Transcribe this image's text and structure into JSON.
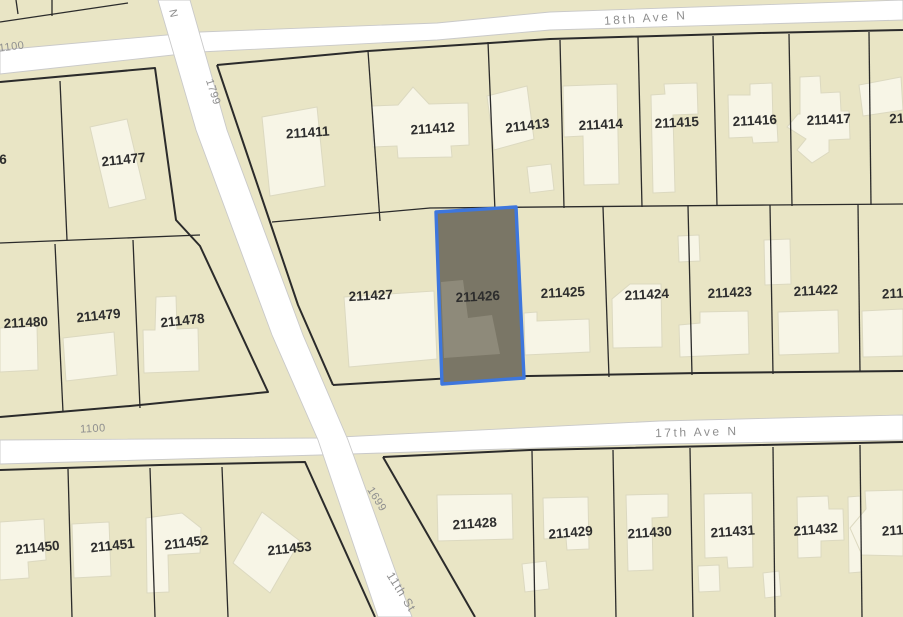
{
  "map": {
    "colors": {
      "parcel_fill": "#e9e5c5",
      "street_fill": "#ffffff",
      "street_casing": "#c9c9c9",
      "parcel_line": "#2b2b2b",
      "building_fill": "#f7f5e6",
      "building_stroke": "#dcd9c0",
      "selected_fill": "#7a7666",
      "selected_stroke": "#3d76dd",
      "selected_building_fill": "#8e8a7a",
      "parcel_label_color": "#2d2d2d",
      "street_label_color": "#8f8f8f"
    },
    "streets": [
      {
        "name": "18th-ave-n",
        "points": "0,50 200,32 437,23 550,12 903,0 903,20 550,30 437,40 200,52 0,74"
      },
      {
        "name": "17th-ave-n",
        "points": "0,440 320,438 660,421 903,415 903,440 660,444 320,455 0,464"
      },
      {
        "name": "cross-street-11th-st",
        "points": "158,0 196,130 233,230 272,335 318,440 378,617 412,617 348,440 303,335 264,230 227,130 190,0"
      }
    ],
    "street_labels": [
      {
        "text": "18th Ave N",
        "x": 646,
        "y": 22,
        "rotate": -4,
        "size": 12,
        "spacing": 2.5
      },
      {
        "text": "17th Ave N",
        "x": 697,
        "y": 436,
        "rotate": -1.5,
        "size": 12,
        "spacing": 2.5
      },
      {
        "text": "1100",
        "x": 12,
        "y": 50,
        "rotate": -7,
        "size": 11,
        "spacing": 0.5
      },
      {
        "text": "1100",
        "x": 93,
        "y": 432,
        "rotate": -3,
        "size": 11,
        "spacing": 0.5
      },
      {
        "text": "1799",
        "x": 210,
        "y": 93,
        "rotate": 72,
        "size": 11,
        "spacing": 0.5
      },
      {
        "text": "1699",
        "x": 374,
        "y": 501,
        "rotate": 58,
        "size": 11,
        "spacing": 0.5
      },
      {
        "text": "11th St",
        "x": 398,
        "y": 594,
        "rotate": 58,
        "size": 12,
        "spacing": 1
      },
      {
        "text": "N",
        "x": 170,
        "y": 14,
        "rotate": 78,
        "size": 11,
        "spacing": 0
      }
    ],
    "parcel_lines": [
      {
        "w": 2,
        "points": "0,82 155,68 176,220 200,246 268,392 130,406 0,417"
      },
      {
        "w": 2,
        "points": "217,65 368,51 550,39 760,33 903,30"
      },
      {
        "w": 2,
        "points": "217,65 245,148 270,222 298,305 333,385"
      },
      {
        "w": 2,
        "points": "333,385 470,377 700,373 903,371"
      },
      {
        "w": 2,
        "points": "0,470 160,465 305,462 375,617"
      },
      {
        "w": 2,
        "points": "383,457 530,450 760,445 903,442"
      },
      {
        "w": 2,
        "points": "383,457 475,617"
      },
      {
        "w": 1.3,
        "points": "0,22 128,3"
      },
      {
        "w": 1.3,
        "points": "52,0 52,16"
      },
      {
        "w": 1.3,
        "points": "16,0 18,14"
      },
      {
        "w": 1.3,
        "points": "0,243 200,235"
      },
      {
        "w": 1.3,
        "points": "60,81 67,240"
      },
      {
        "w": 1.3,
        "points": "55,244 63,412"
      },
      {
        "w": 1.3,
        "points": "133,240 140,408"
      },
      {
        "w": 1.3,
        "points": "272,222 430,208 770,205 903,204"
      },
      {
        "w": 1.3,
        "points": "368,51 380,221"
      },
      {
        "w": 1.3,
        "points": "488,42 495,211"
      },
      {
        "w": 1.3,
        "points": "560,40 564,208"
      },
      {
        "w": 1.3,
        "points": "638,37 642,207"
      },
      {
        "w": 1.3,
        "points": "713,36 717,206"
      },
      {
        "w": 1.3,
        "points": "789,34 792,206"
      },
      {
        "w": 1.3,
        "points": "869,32 871,205"
      },
      {
        "w": 1.3,
        "points": "603,207 609,377"
      },
      {
        "w": 1.3,
        "points": "688,206 692,375"
      },
      {
        "w": 1.3,
        "points": "770,205 773,374"
      },
      {
        "w": 1.3,
        "points": "858,204 860,372"
      },
      {
        "w": 1.3,
        "points": "68,469 72,617"
      },
      {
        "w": 1.3,
        "points": "150,468 155,617"
      },
      {
        "w": 1.3,
        "points": "222,467 228,617"
      },
      {
        "w": 1.3,
        "points": "532,451 535,617"
      },
      {
        "w": 1.3,
        "points": "613,450 616,617"
      },
      {
        "w": 1.3,
        "points": "690,448 693,617"
      },
      {
        "w": 1.3,
        "points": "773,447 775,617"
      },
      {
        "w": 1.3,
        "points": "860,445 862,617"
      }
    ],
    "buildings": [
      {
        "points": "90,127 127,119 146,199 109,208"
      },
      {
        "points": "0,328 37,326 38,370 0,372"
      },
      {
        "points": "63,338 114,332 117,375 66,381"
      },
      {
        "points": "156,297 176,296 177,329 198,328 199,371 144,373 143,330 155,330"
      },
      {
        "points": "262,117 317,107 325,186 270,196"
      },
      {
        "points": "372,106 398,105 413,87 429,104 468,103 469,145 451,146 452,157 398,158 397,146 373,147"
      },
      {
        "points": "487,96 527,86 534,139 494,150"
      },
      {
        "points": "527,167 551,164 554,190 530,193"
      },
      {
        "points": "563,86 617,84 619,184 584,185 583,136 564,137"
      },
      {
        "points": "651,95 665,94 664,84 697,83 698,114 673,115 675,192 653,193"
      },
      {
        "points": "750,84 772,83 773,124 777,124 778,142 753,143 752,137 729,138 728,95 750,95"
      },
      {
        "points": "800,77 820,76 821,93 840,92 841,111 849,111 850,139 829,140 829,152 812,163 797,150 806,139 787,127 798,114 800,114"
      },
      {
        "points": "859,85 901,77 903,110 863,116"
      },
      {
        "points": "344,297 434,291 437,359 349,367"
      },
      {
        "points": "524,313 537,312 537,321 589,319 590,352 525,355"
      },
      {
        "points": "612,299 630,284 661,284 662,347 613,348"
      },
      {
        "points": "678,236 699,235 700,261 679,262"
      },
      {
        "points": "679,325 700,323 700,312 748,311 749,354 680,357"
      },
      {
        "points": "764,240 790,239 791,284 765,285"
      },
      {
        "points": "778,312 838,310 839,353 779,355"
      },
      {
        "points": "862,311 903,309 903,356 863,357"
      },
      {
        "points": "0,522 44,519 46,560 28,562 29,578 0,580"
      },
      {
        "points": "72,524 109,522 111,576 74,578"
      },
      {
        "points": "146,518 182,513 201,528 200,553 168,555 169,592 147,593"
      },
      {
        "points": "262,512 300,541 270,593 233,563"
      },
      {
        "points": "437,495 512,494 513,539 438,541"
      },
      {
        "points": "543,498 588,497 589,549 567,550 566,538 544,539"
      },
      {
        "points": "522,564 546,561 549,589 525,592"
      },
      {
        "points": "626,495 668,494 668,517 652,518 653,570 628,571"
      },
      {
        "points": "704,494 752,493 753,567 728,568 727,557 705,558"
      },
      {
        "points": "698,566 719,565 720,591 699,592"
      },
      {
        "points": "797,497 828,496 829,509 843,509 844,540 821,541 821,557 798,558"
      },
      {
        "points": "763,573 779,571 781,596 765,598"
      },
      {
        "points": "848,497 860,496 861,572 849,573"
      },
      {
        "points": "865,491 903,490 903,556 862,555 850,528 866,509"
      }
    ],
    "selected_parcel": {
      "label": "211426",
      "points": "436,212 516,207 524,378 442,384",
      "building_points": "441,282 463,280 468,318 492,315 500,354 444,358",
      "label_x": 478,
      "label_y": 301,
      "rotate": -3
    },
    "parcel_labels": [
      {
        "text": "211411",
        "x": 308,
        "y": 137,
        "rotate": -4
      },
      {
        "text": "211412",
        "x": 433,
        "y": 133,
        "rotate": -4
      },
      {
        "text": "211413",
        "x": 528,
        "y": 130,
        "rotate": -7
      },
      {
        "text": "211414",
        "x": 601,
        "y": 129,
        "rotate": -3
      },
      {
        "text": "211415",
        "x": 677,
        "y": 127,
        "rotate": -3
      },
      {
        "text": "211416",
        "x": 755,
        "y": 125,
        "rotate": -3
      },
      {
        "text": "211417",
        "x": 829,
        "y": 124,
        "rotate": -3
      },
      {
        "text": "21",
        "x": 897,
        "y": 123,
        "rotate": -3
      },
      {
        "text": "211477",
        "x": 124,
        "y": 164,
        "rotate": -6
      },
      {
        "text": "6",
        "x": 3,
        "y": 164,
        "rotate": 0
      },
      {
        "text": "211427",
        "x": 371,
        "y": 300,
        "rotate": -3
      },
      {
        "text": "211425",
        "x": 563,
        "y": 297,
        "rotate": -3
      },
      {
        "text": "211424",
        "x": 647,
        "y": 299,
        "rotate": -3
      },
      {
        "text": "211423",
        "x": 730,
        "y": 297,
        "rotate": -3
      },
      {
        "text": "211422",
        "x": 816,
        "y": 295,
        "rotate": -3
      },
      {
        "text": "211",
        "x": 893,
        "y": 298,
        "rotate": -3
      },
      {
        "text": "211480",
        "x": 26,
        "y": 327,
        "rotate": -3
      },
      {
        "text": "211479",
        "x": 99,
        "y": 320,
        "rotate": -6
      },
      {
        "text": "211478",
        "x": 183,
        "y": 325,
        "rotate": -6
      },
      {
        "text": "211450",
        "x": 38,
        "y": 552,
        "rotate": -6
      },
      {
        "text": "211451",
        "x": 113,
        "y": 550,
        "rotate": -6
      },
      {
        "text": "211452",
        "x": 187,
        "y": 547,
        "rotate": -7
      },
      {
        "text": "211453",
        "x": 290,
        "y": 553,
        "rotate": -6
      },
      {
        "text": "211428",
        "x": 475,
        "y": 528,
        "rotate": -4
      },
      {
        "text": "211429",
        "x": 571,
        "y": 537,
        "rotate": -5
      },
      {
        "text": "211430",
        "x": 650,
        "y": 537,
        "rotate": -4
      },
      {
        "text": "211431",
        "x": 733,
        "y": 536,
        "rotate": -4
      },
      {
        "text": "211432",
        "x": 816,
        "y": 534,
        "rotate": -5
      },
      {
        "text": "211",
        "x": 893,
        "y": 535,
        "rotate": -4
      }
    ]
  }
}
